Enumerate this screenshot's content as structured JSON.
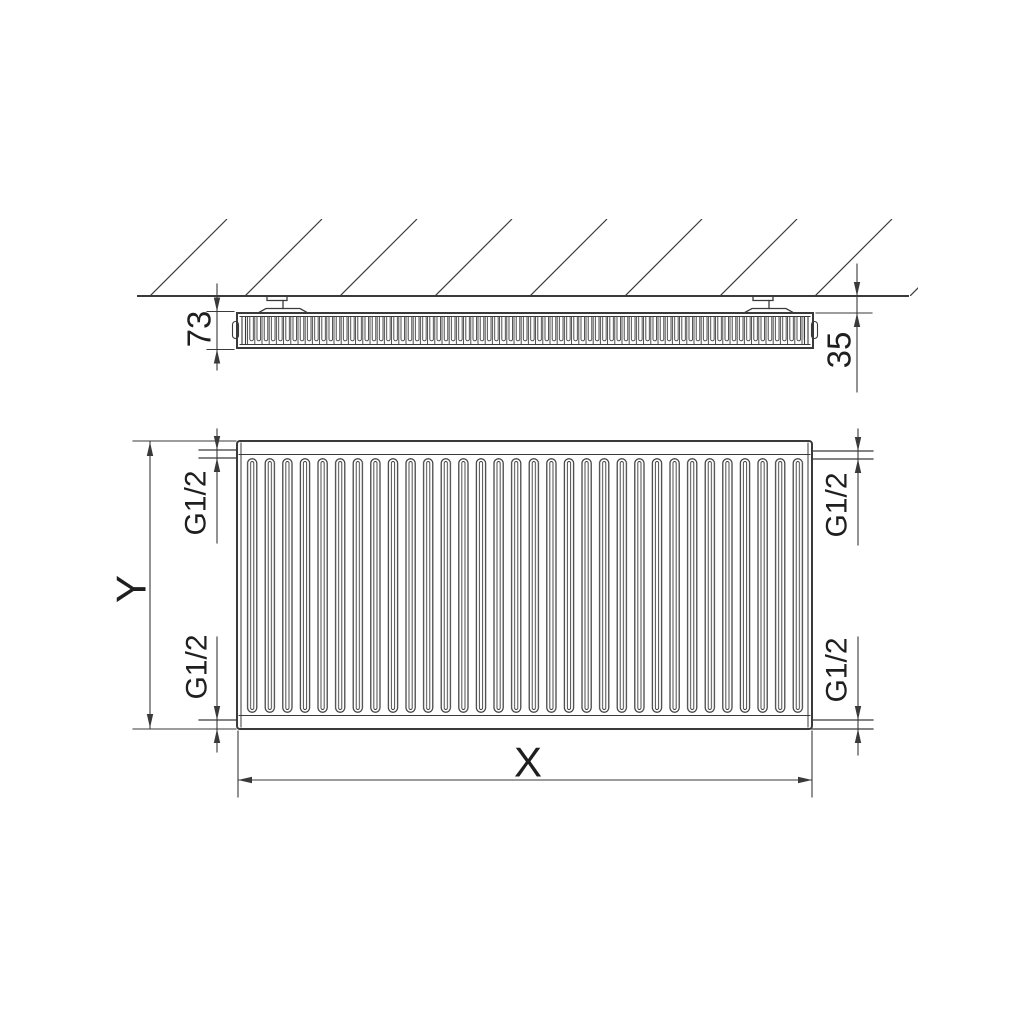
{
  "dimensions": {
    "side_view": {
      "depth": "73",
      "wall_distance": "35"
    },
    "front_view": {
      "width": "X",
      "height": "Y",
      "connection_top_left": "G1/2",
      "connection_bottom_left": "G1/2",
      "connection_top_right": "G1/2",
      "connection_bottom_right": "G1/2"
    }
  },
  "colors": {
    "line": "#3a3a3a",
    "text": "#1f1f1f",
    "background": "#ffffff"
  }
}
